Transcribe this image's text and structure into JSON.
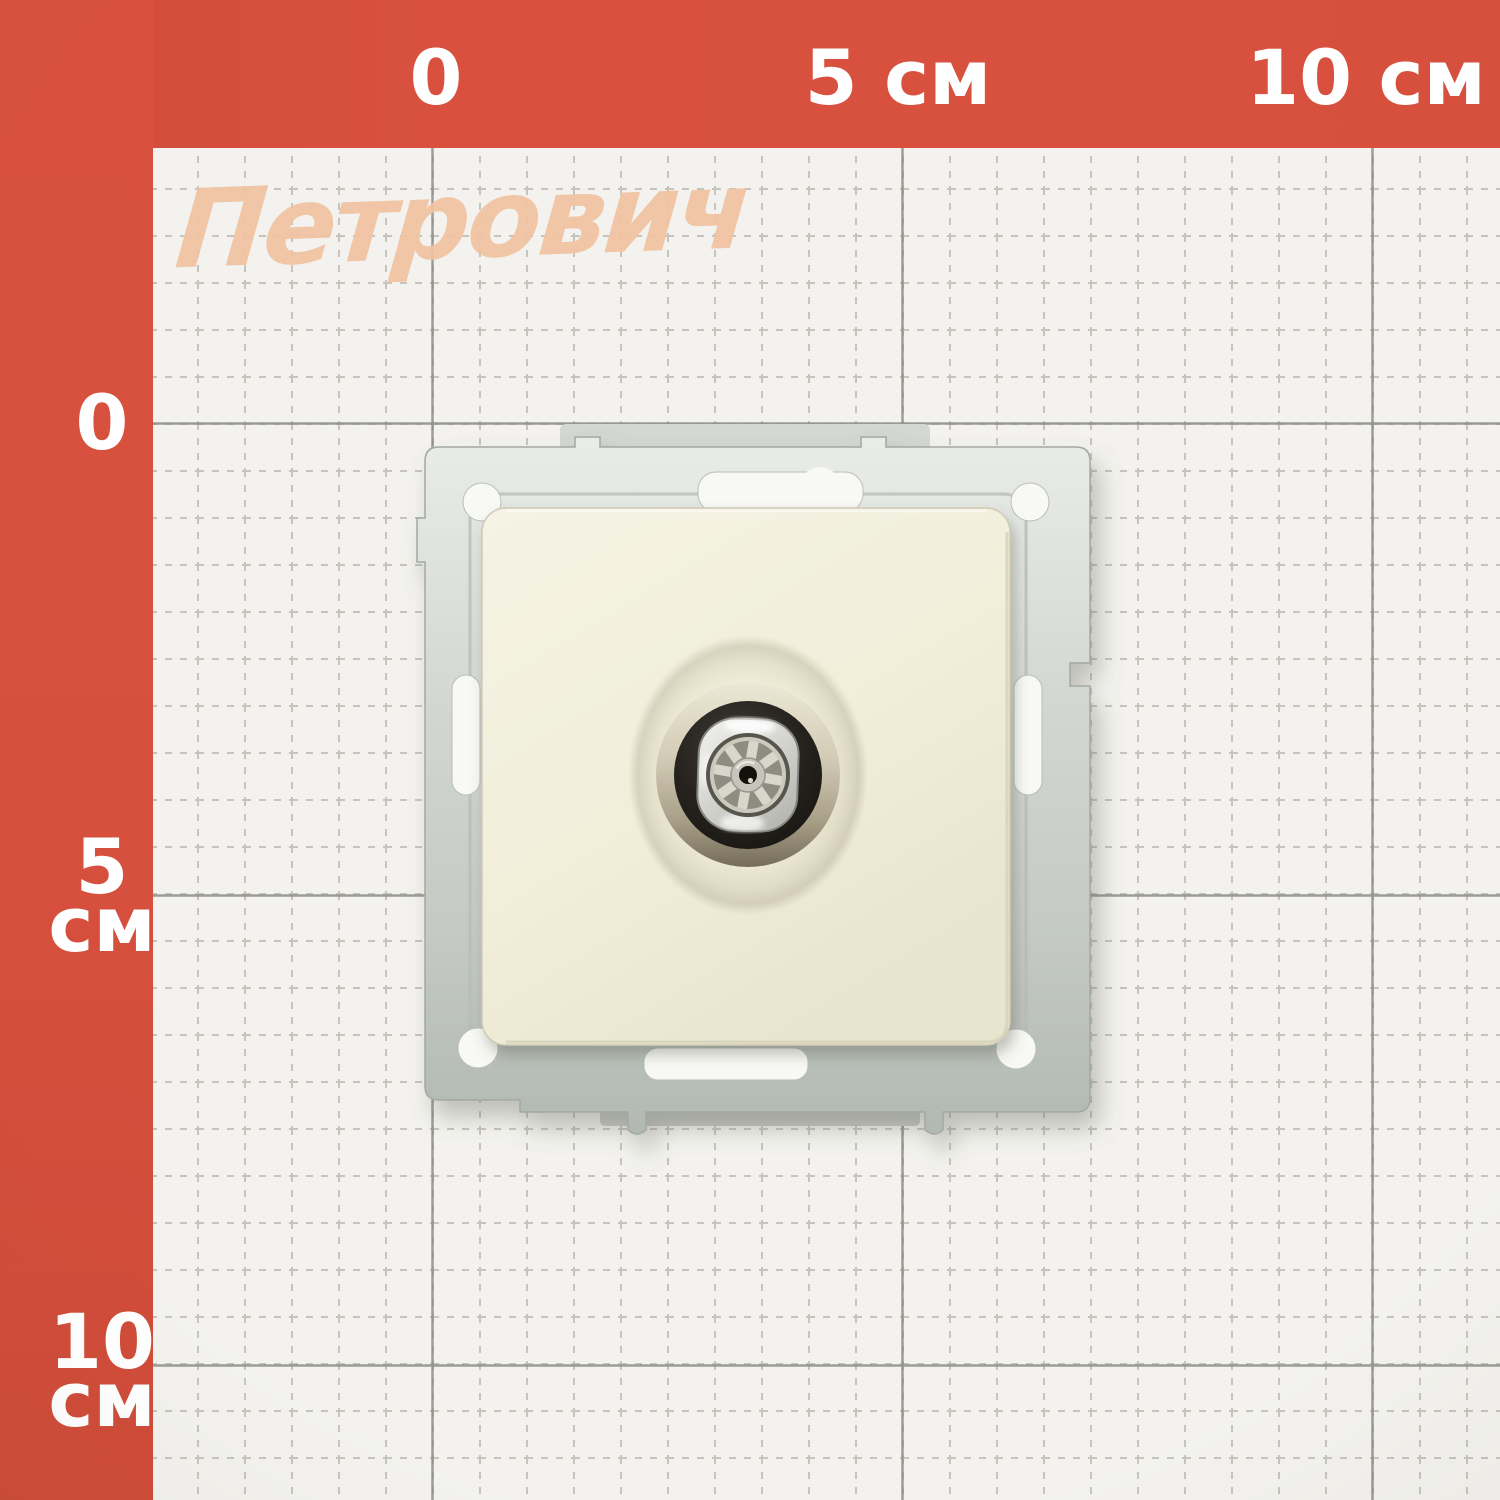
{
  "scene": {
    "description": "Product photograph: beige TV antenna socket mechanism with zinc mounting frame lying on Petrovich centimeter grid paper",
    "watermark": "Петрович"
  },
  "ruler": {
    "top_labels": [
      {
        "text": "0"
      },
      {
        "text": "5 см"
      },
      {
        "text": "10 см"
      }
    ],
    "left_labels": [
      {
        "number": "0",
        "unit": ""
      },
      {
        "number": "5",
        "unit": "см"
      },
      {
        "number": "10",
        "unit": "см"
      }
    ]
  },
  "colors": {
    "border_red": "#d7503e",
    "paper": "#f3f2ee",
    "grid_minor": "#c6c4bd",
    "grid_major": "#8b8e86",
    "label_white": "#ffffff",
    "watermark_peach": "#f1c3a0",
    "metal_frame": "#cdd2cc",
    "faceplate_cream": "#f1eeda",
    "recess_shadow": "#746c59",
    "connector_ring_black": "#23211c",
    "connector_nut_silver": "#d8d9d4",
    "insulator_wheel": "#d8d7cb",
    "pin_hole_dark": "#14100a"
  },
  "product": {
    "kind": "tv-antenna-socket-mechanism",
    "parts": {
      "frame": "metal-mounting-frame",
      "plate": "cream-faceplate",
      "connector": "coaxial-tv-connector",
      "insulator": "eight-spoke-insulator-wheel",
      "contact": "center-pin-socket"
    }
  }
}
